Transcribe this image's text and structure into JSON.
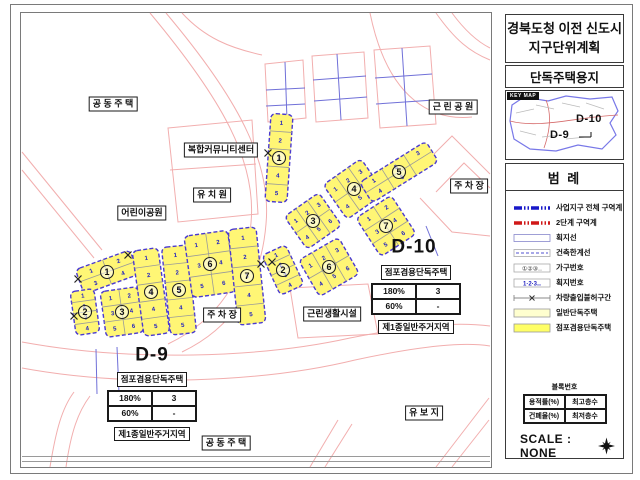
{
  "sidebar": {
    "title_line1": "경북도청 이전 신도시",
    "title_line2": "지구단위계획",
    "subtitle": "단독주택용지",
    "keymap": {
      "chip": "KEY MAP",
      "d10": "D-10",
      "d9": "D-9"
    },
    "legend": {
      "title": "범    례",
      "items": [
        {
          "symbol": "boundary-blue",
          "label": "사업지구 전체 구역계"
        },
        {
          "symbol": "boundary-red",
          "label": "2단계 구역계"
        },
        {
          "symbol": "box-line",
          "label": "획지선"
        },
        {
          "symbol": "box-dash",
          "label": "건축한계선"
        },
        {
          "symbol": "circled-nums",
          "label": "가구번호"
        },
        {
          "symbol": "nums",
          "label": "획지번호"
        },
        {
          "symbol": "no-vehicle",
          "label": "차량출입불허구간"
        },
        {
          "symbol": "fill-light",
          "label": "일반단독주택"
        },
        {
          "symbol": "fill-strong",
          "label": "점포겸용단독주택"
        }
      ]
    },
    "blocknum": {
      "title": "블록번호",
      "cells": [
        [
          "용적률(%)",
          "최고층수"
        ],
        [
          "건폐율(%)",
          "최저층수"
        ]
      ]
    },
    "scale_text": "SCALE : NONE"
  },
  "map": {
    "labels": [
      {
        "text": "공 동 주 택",
        "x": 113,
        "y": 104
      },
      {
        "text": "근 린 공 원",
        "x": 453,
        "y": 107
      },
      {
        "text": "복합커뮤니티센터",
        "x": 221,
        "y": 150
      },
      {
        "text": "유 치 원",
        "x": 212,
        "y": 195
      },
      {
        "text": "어린이공원",
        "x": 142,
        "y": 213
      },
      {
        "text": "주 차 장",
        "x": 469,
        "y": 186
      },
      {
        "text": "주 차 장",
        "x": 222,
        "y": 315
      },
      {
        "text": "근린생활시설",
        "x": 332,
        "y": 314
      },
      {
        "text": "유 보 지",
        "x": 424,
        "y": 413
      },
      {
        "text": "공 동 주 택",
        "x": 226,
        "y": 443
      },
      {
        "text": "D-9",
        "x": 152,
        "y": 355,
        "plain": true
      },
      {
        "text": "D-10",
        "x": 414,
        "y": 247,
        "plain": true
      }
    ],
    "district_tables": [
      {
        "name": "D-9",
        "x": 152,
        "y": 372,
        "header": "점포겸용단독주택",
        "rows": [
          [
            "180%",
            "3"
          ],
          [
            "60%",
            "-"
          ]
        ],
        "footer": "제1종일반주거지역"
      },
      {
        "name": "D-10",
        "x": 416,
        "y": 265,
        "header": "점포겸용단독주택",
        "rows": [
          [
            "180%",
            "3"
          ],
          [
            "60%",
            "-"
          ]
        ],
        "footer": "제1종일반주거지역"
      }
    ],
    "blocks": [
      {
        "group": "D-9",
        "no": "1",
        "cx": 107,
        "cy": 272,
        "w": 58,
        "h": 26,
        "angle": -20,
        "lots": 4
      },
      {
        "group": "D-9",
        "no": "2",
        "cx": 85,
        "cy": 312,
        "w": 24,
        "h": 44,
        "angle": -8,
        "lots": 4
      },
      {
        "group": "D-9",
        "no": "3",
        "cx": 122,
        "cy": 312,
        "w": 38,
        "h": 46,
        "angle": -8,
        "lots": 6
      },
      {
        "group": "D-9",
        "no": "4",
        "cx": 151,
        "cy": 292,
        "w": 26,
        "h": 86,
        "angle": -8,
        "lots": 5
      },
      {
        "group": "D-9",
        "no": "5",
        "cx": 179,
        "cy": 290,
        "w": 26,
        "h": 88,
        "angle": -6,
        "lots": 5
      },
      {
        "group": "D-9",
        "no": "6",
        "cx": 210,
        "cy": 264,
        "w": 44,
        "h": 62,
        "angle": -8,
        "lots": 6
      },
      {
        "group": "D-9",
        "no": "7",
        "cx": 247,
        "cy": 276,
        "w": 28,
        "h": 96,
        "angle": -6,
        "lots": 5
      },
      {
        "group": "D-10",
        "no": "1",
        "cx": 279,
        "cy": 158,
        "w": 22,
        "h": 88,
        "angle": 4,
        "lots": 5
      },
      {
        "group": "D-10",
        "no": "2",
        "cx": 283,
        "cy": 270,
        "w": 26,
        "h": 44,
        "angle": -25,
        "lots": 4
      },
      {
        "group": "D-10",
        "no": "3",
        "cx": 313,
        "cy": 221,
        "w": 42,
        "h": 40,
        "angle": -35,
        "lots": 6
      },
      {
        "group": "D-10",
        "no": "4",
        "cx": 354,
        "cy": 189,
        "w": 46,
        "h": 42,
        "angle": -35,
        "lots": 6
      },
      {
        "group": "D-10",
        "no": "5",
        "cx": 399,
        "cy": 172,
        "w": 78,
        "h": 24,
        "angle": -32,
        "lots": 5
      },
      {
        "group": "D-10",
        "no": "6",
        "cx": 329,
        "cy": 267,
        "w": 46,
        "h": 42,
        "angle": -30,
        "lots": 6
      },
      {
        "group": "D-10",
        "no": "7",
        "cx": 386,
        "cy": 226,
        "w": 42,
        "h": 46,
        "angle": -33,
        "lots": 6
      }
    ],
    "xmarks": [
      [
        78,
        279
      ],
      [
        74,
        316
      ],
      [
        261,
        264
      ],
      [
        272,
        262
      ],
      [
        268,
        153
      ],
      [
        128,
        255
      ]
    ],
    "colors": {
      "road": "#F2AEAE",
      "grid_blue": "#7070D8",
      "parcel_fill": "#FFF675",
      "parcel_fill_light": "#FFFFCF",
      "parcel_border": "#4A3AD0",
      "inner_line": "#9A9A9A",
      "lot_number": "#2020C0",
      "boundary_blue": "#1818C8",
      "boundary_red": "#D01818",
      "keymap_outline": "#7878E8"
    }
  }
}
